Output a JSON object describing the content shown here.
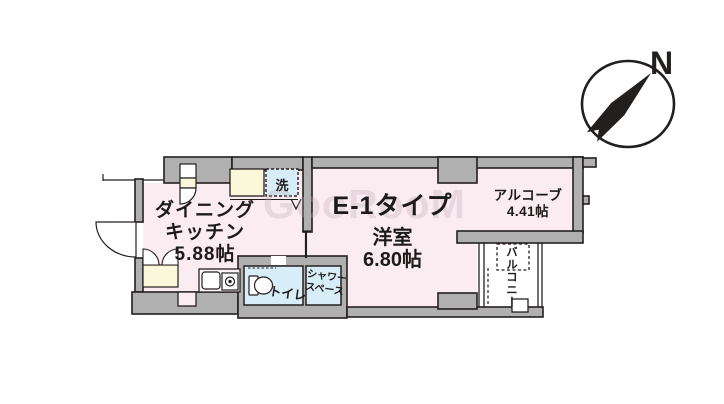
{
  "watermark": "GooRooM",
  "compass": {
    "north_label": "N"
  },
  "rooms": {
    "dining_kitchen": {
      "line1": "ダイニング",
      "line2": "キッチン",
      "size": "5.88帖"
    },
    "unit": {
      "type": "E-1タイプ",
      "room": "洋室",
      "size": "6.80帖"
    },
    "alcove": {
      "name": "アルコーブ",
      "size": "4.41帖"
    },
    "balcony": {
      "name": "バルコニー"
    },
    "toilet": {
      "name": "トイレ"
    },
    "shower": {
      "line1": "シャワー",
      "line2": "スペース"
    },
    "laundry": {
      "label": "洗"
    }
  },
  "colors": {
    "room_pink": "#faecf1",
    "water_blue": "#d7edf7",
    "fixture_yellow": "#fbf7da",
    "wall_gray": "#b1b0b0",
    "line_black": "#241f1f"
  }
}
